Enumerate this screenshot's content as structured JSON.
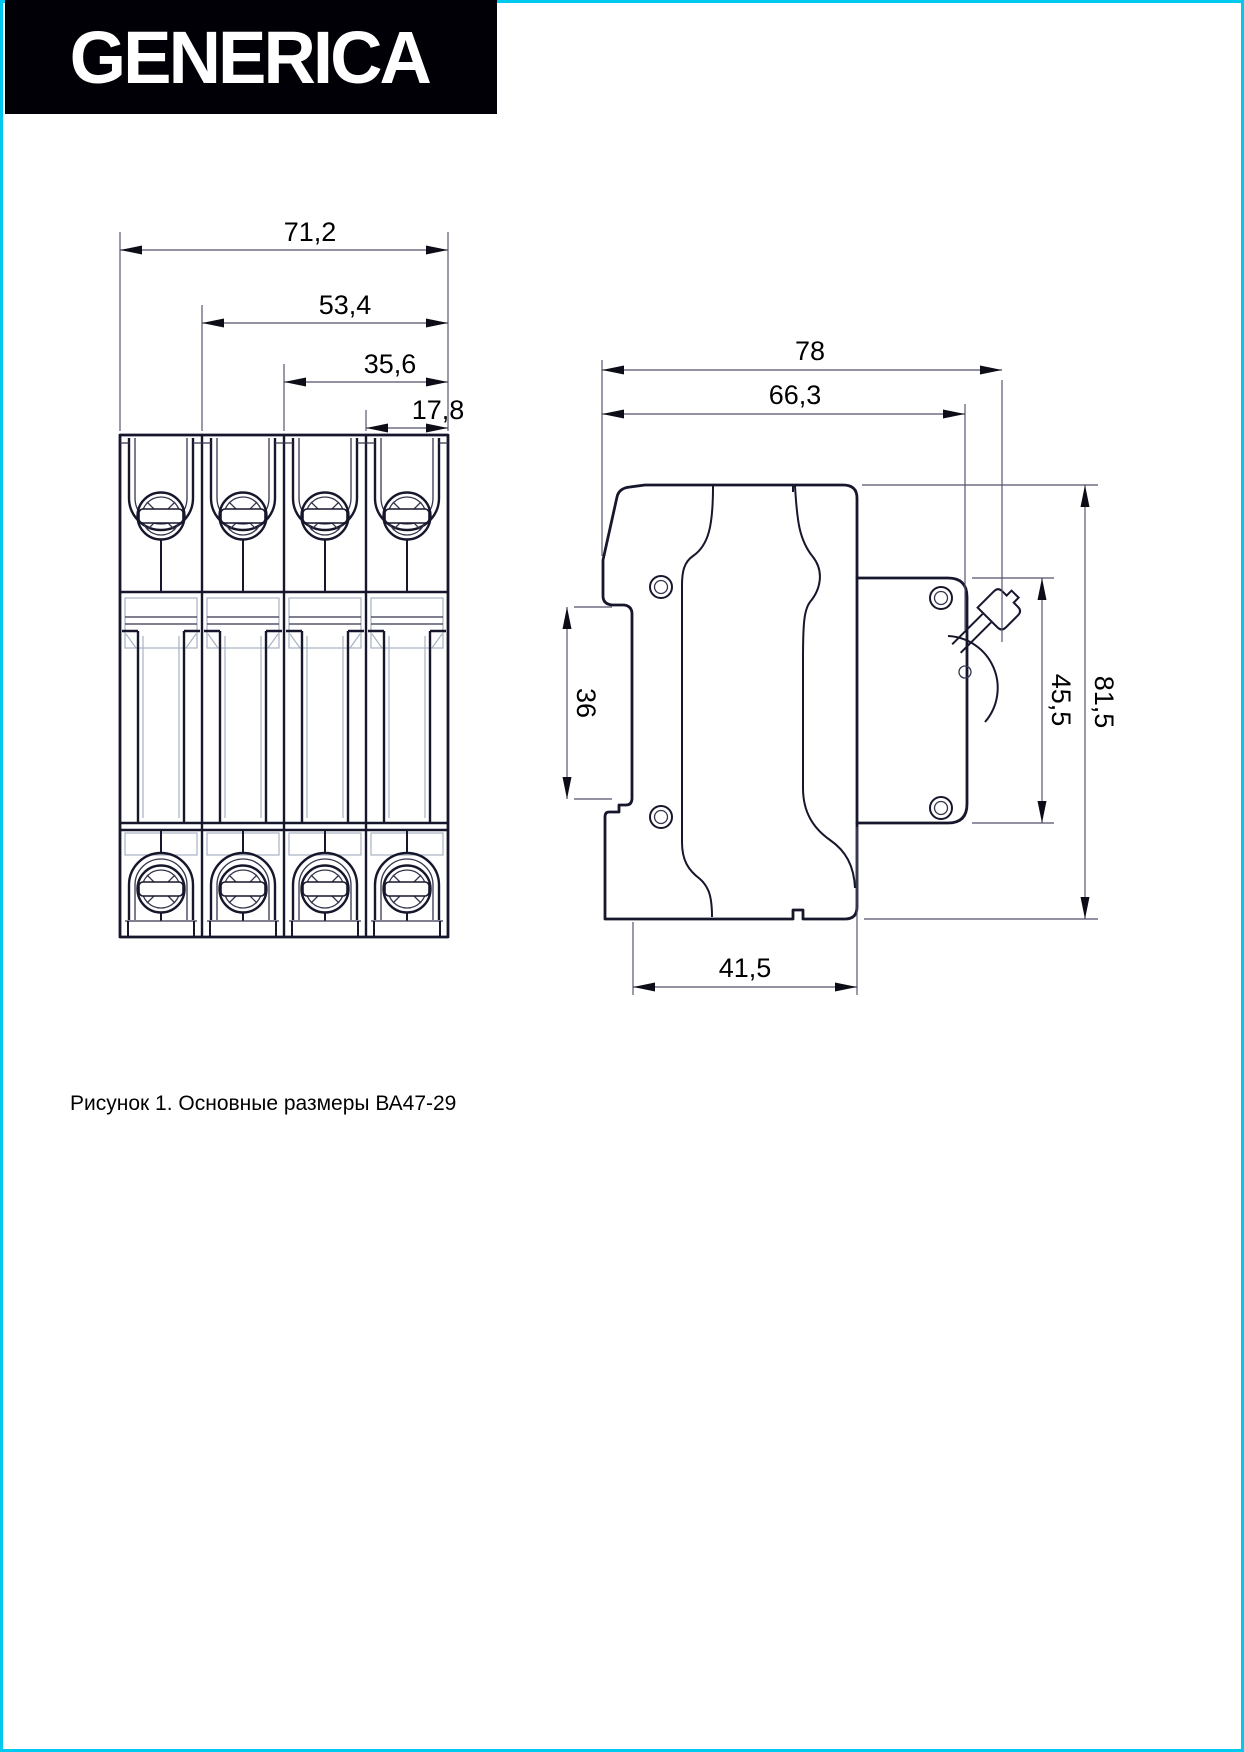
{
  "page": {
    "border_color": "#00c9f0",
    "background": "#ffffff"
  },
  "logo": {
    "text": "GENERICA",
    "bg": "#000006",
    "fg": "#ffffff"
  },
  "figure": {
    "caption": "Рисунок 1. Основные размеры ВА47-29",
    "front_view": {
      "dims": {
        "total_width": "71,2",
        "three_pole": "53,4",
        "two_pole": "35,6",
        "one_pole": "17,8"
      }
    },
    "side_view": {
      "dims": {
        "depth_with_lever": "78",
        "depth_body": "66,3",
        "din_rail": "36",
        "front_panel_height": "45,5",
        "total_height": "81,5",
        "base_depth": "41,5"
      }
    }
  }
}
